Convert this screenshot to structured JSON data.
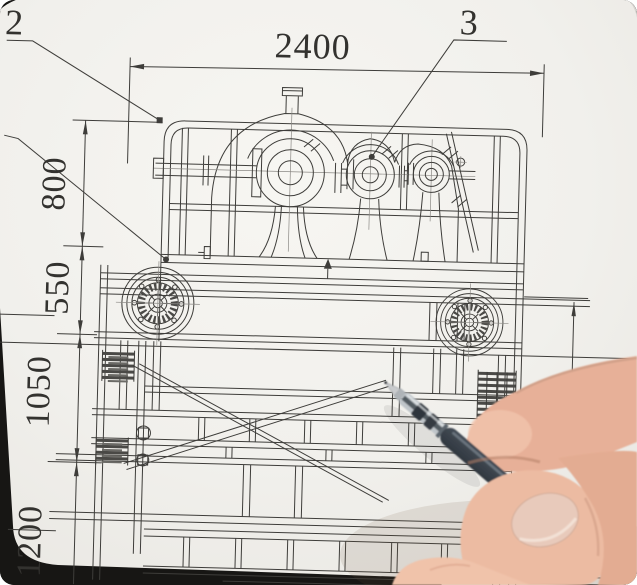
{
  "drawing": {
    "callouts": {
      "upper_left": "2",
      "top": "3"
    },
    "dimensions": {
      "width": "2400",
      "left": [
        "800",
        "550",
        "1050",
        "1200"
      ],
      "right": "1403"
    }
  },
  "objects": {
    "paper": "engineering-drawing-sheet",
    "hand": "right-hand-holding-pen",
    "pen": "gel-pen"
  },
  "colors": {
    "paper": "#f3f2ee",
    "ink": "#3e3d3a",
    "desk": "#171614",
    "background_top": "#d6d3cf",
    "pen_barrel": "#49525c",
    "skin": "#e9b79e"
  }
}
